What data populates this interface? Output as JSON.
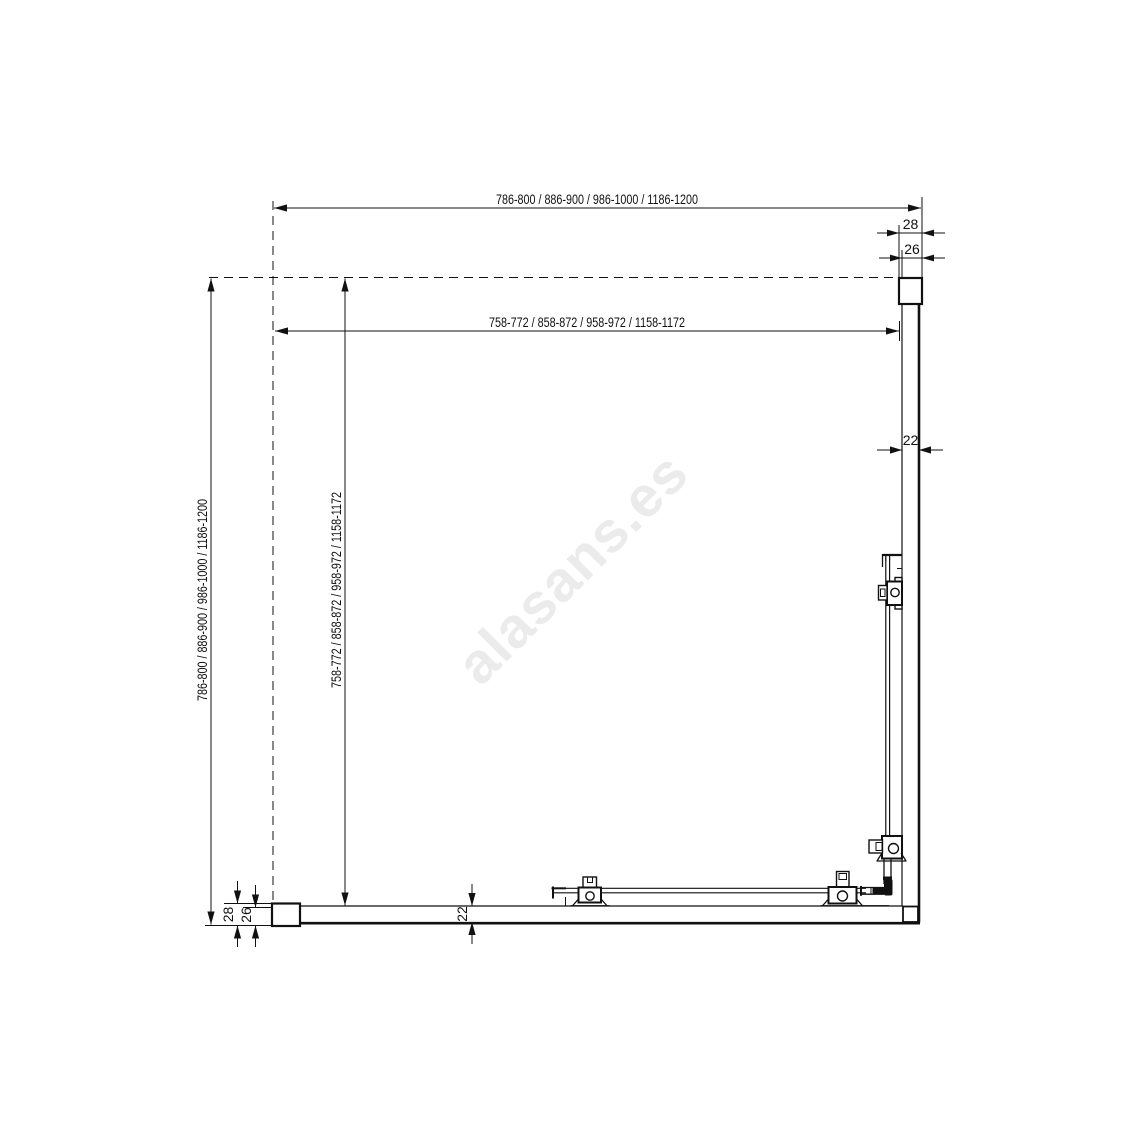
{
  "watermark": {
    "text": "alasans.es"
  },
  "dimensions": {
    "top_outer": "786-800 / 886-900 / 986-1000 / 1186-1200",
    "top_inner": "758-772 / 858-872 / 958-972 / 1158-1172",
    "left_outer": "786-800 / 886-900 / 986-1000 / 1186-1200",
    "left_inner": "758-772 / 858-872 / 958-972 / 1158-1172",
    "top_profile_width": "28",
    "top_profile_inset": "26",
    "right_glass_offset": "22",
    "left_profile_width": "28",
    "left_profile_inset": "26",
    "bottom_glass_offset": "22"
  },
  "colors": {
    "line": "#111111",
    "watermark": "#ebebeb",
    "background": "#ffffff"
  }
}
